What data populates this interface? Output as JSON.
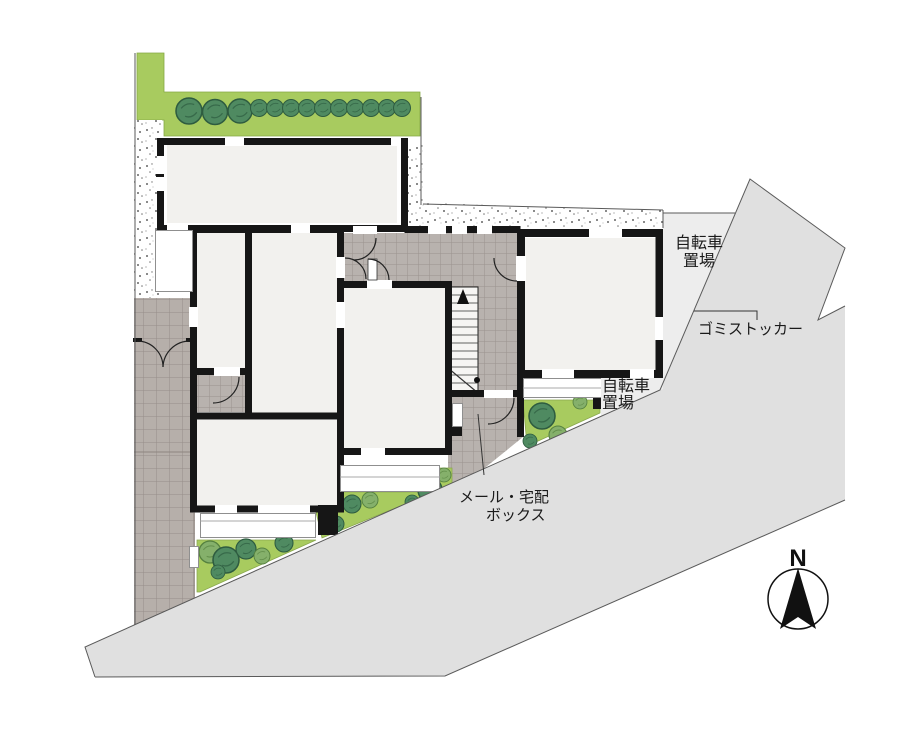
{
  "plan": {
    "compass": {
      "north_label": "N"
    },
    "labels": {
      "bicycle_upper": {
        "line1": "自転車",
        "line2": "置場"
      },
      "bicycle_lower": {
        "line1": "自転車",
        "line2": "置場"
      },
      "garbage_stocker": "ゴミストッカー",
      "mail_delivery_box": {
        "line1": "メール・宅配",
        "line2": "ボックス"
      }
    },
    "colors": {
      "road": "#e0e0e0",
      "bicycle_area": "#ededed",
      "lawn": "#a8cb5f",
      "tree": "#4f8a61",
      "bush_light": "#85b06b",
      "tile_path": "#b6afaa",
      "wall": "#161616",
      "room": "#f2f1ee",
      "boundary_line": "#5a5a5a"
    }
  }
}
